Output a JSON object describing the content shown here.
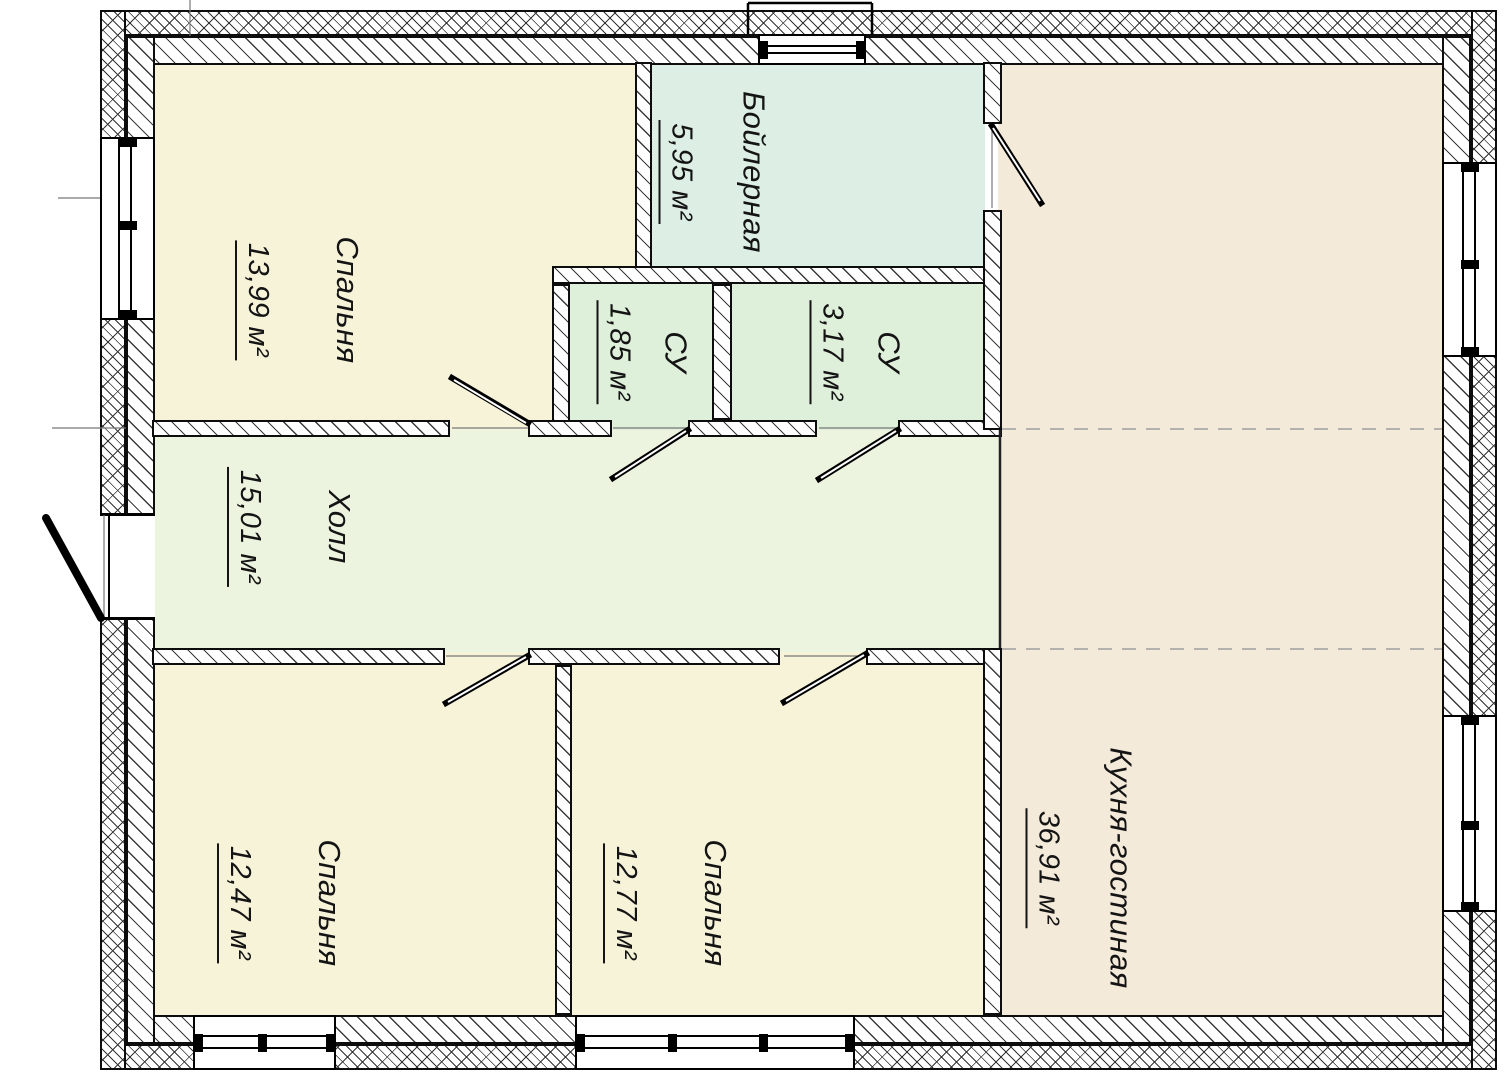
{
  "plan": {
    "type": "floor-plan",
    "language": "ru",
    "rooms": [
      {
        "id": "bedroom-top",
        "name": "Спальня",
        "area": "13,99 м²"
      },
      {
        "id": "boiler",
        "name": "Бойлерная",
        "area": "5,95 м²"
      },
      {
        "id": "wc-small",
        "name": "СУ",
        "area": "1,85 м²"
      },
      {
        "id": "wc-big",
        "name": "СУ",
        "area": "3,17 м²"
      },
      {
        "id": "hall",
        "name": "Холл",
        "area": "15,01 м²"
      },
      {
        "id": "kitchen-living",
        "name": "Кухня-гостиная",
        "area": "36,91 м²"
      },
      {
        "id": "bedroom-left",
        "name": "Спальня",
        "area": "12,47 м²"
      },
      {
        "id": "bedroom-mid",
        "name": "Спальня",
        "area": "12,77 м²"
      }
    ],
    "colors": {
      "bedroom": "#f7f3d9",
      "boiler": "#ddefe4",
      "bathroom": "#dff0da",
      "hall": "#ecf3de",
      "kitchen": "#f4ead9",
      "wall_line": "#0d0d0d",
      "paper": "#ffffff"
    }
  }
}
